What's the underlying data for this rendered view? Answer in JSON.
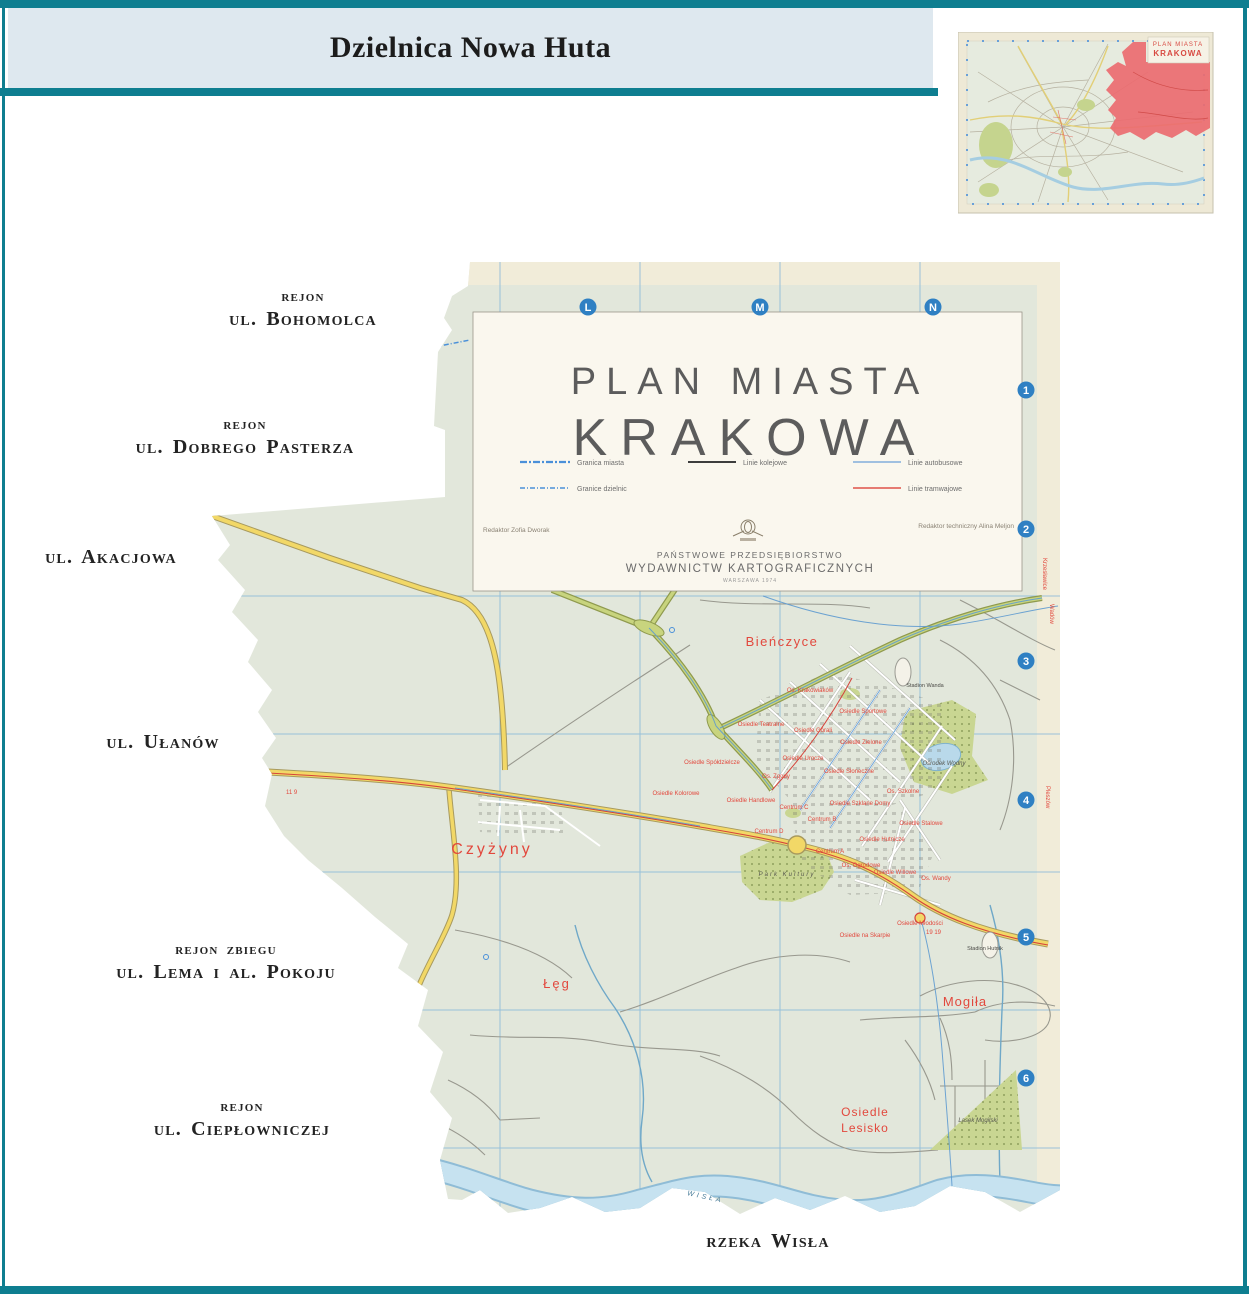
{
  "page": {
    "accent_teal": "#0e7e90",
    "header_bg": "#dee8ef",
    "map_base": "#e2e7db",
    "district_red": "#ec6b70",
    "road_yellow": "#f2d867",
    "tram_red": "#d5443c",
    "park_green": "#c9d692",
    "water_blue": "#bcdcea",
    "grid_blue": "#7fb3d9",
    "index_circle_blue": "#2f80c3"
  },
  "header": {
    "title": "Dzielnica Nowa Huta"
  },
  "inset": {
    "title_line1": "PLAN MIASTA",
    "title_line2": "KRAKOWA"
  },
  "annotations": {
    "bohomolca_line1": "rejon",
    "bohomolca_line2": "ul. Bohomolca",
    "dobrego_line1": "rejon",
    "dobrego_line2": "ul. Dobrego Pasterza",
    "akacjowa": "ul. Akacjowa",
    "ulanow": "ul. Ułanów",
    "lema_line1": "rejon zbiegu",
    "lema_line2": "ul. Lema i al. Pokoju",
    "cieplownicza_line1": "rejon",
    "cieplownicza_line2": "ul. Ciepłowniczej",
    "rzeka_wisla": "rzeka Wisła"
  },
  "map": {
    "grid_letters": [
      "L",
      "M",
      "N"
    ],
    "grid_numbers": [
      "1",
      "2",
      "3",
      "4",
      "5",
      "6"
    ],
    "cartouche": {
      "title_line1": "PLAN MIASTA",
      "title_line2": "KRAKOWA",
      "legend": [
        {
          "label": "Granica miasta"
        },
        {
          "label": "Granice dzielnic"
        },
        {
          "label": "Linie kolejowe"
        },
        {
          "label": "Linie autobusowe"
        },
        {
          "label": "Linie tramwajowe"
        }
      ],
      "credit_left": "Redaktor Zofia Dworak",
      "credit_right": "Redaktor techniczny Alina Meljon",
      "publisher_line1": "PAŃSTWOWE PRZEDSIĘBIORSTWO",
      "publisher_line2": "WYDAWNICTW KARTOGRAFICZNYCH",
      "publisher_line3": "WARSZAWA 1974"
    },
    "margin_labels": {
      "krzeslawice": "Krzesławice",
      "wadow": "Wadów",
      "pleszow": "Pleszów"
    },
    "tram_numbers_west": "11 9",
    "tram_numbers_east": "19 19",
    "places": {
      "bienczyce": "Bieńczyce",
      "czyzyny": "Czyżyny",
      "leg": "Łęg",
      "mogila": "Mogiła",
      "lesisko_line1": "Osiedle",
      "lesisko_line2": "Lesisko",
      "os_kolorowe": "Osiedle Kolorowe",
      "os_spoldzielcze": "Osiedle Spółdzielcze",
      "os_teatralne": "Osiedle Teatralne",
      "os_krakowiakow": "Os. Krakowiaków",
      "os_sportowe": "Osiedle Sportowe",
      "os_gorali": "Osiedle Górali",
      "os_zielone": "Osiedle Zielone",
      "os_urocze": "Osiedle Urocze",
      "os_zgody": "Os. Zgody",
      "os_sloneczne": "Osiedle Słoneczne",
      "os_szkolne": "Os. Szkolne",
      "os_handlowe": "Osiedle Handlowe",
      "os_szklane_domy": "Osiedle Szklane Domy",
      "os_stalowe": "Osiedle Stalowe",
      "centrum_a": "Centrum A",
      "centrum_b": "Centrum B",
      "centrum_c": "Centrum C",
      "centrum_d": "Centrum D",
      "os_hutnicze": "Osiedle Hutnicze",
      "os_ogrodowe": "Os. Ogrodowe",
      "os_willowe": "Osiedle Willowe",
      "os_wandy": "Os. Wandy",
      "os_mlodosci": "Osiedle Młodości",
      "os_na_skarpie": "Osiedle na Skarpie",
      "stadion_wanda": "Stadion Wanda",
      "osrodek_wodny": "Ośrodek Wodny",
      "park_kultury": "Park Kultury",
      "stadion_hutnik": "Stadion Hutnik",
      "lasek_mogilski": "Lasek Mogilski",
      "wisla_river": "WISŁA"
    }
  }
}
